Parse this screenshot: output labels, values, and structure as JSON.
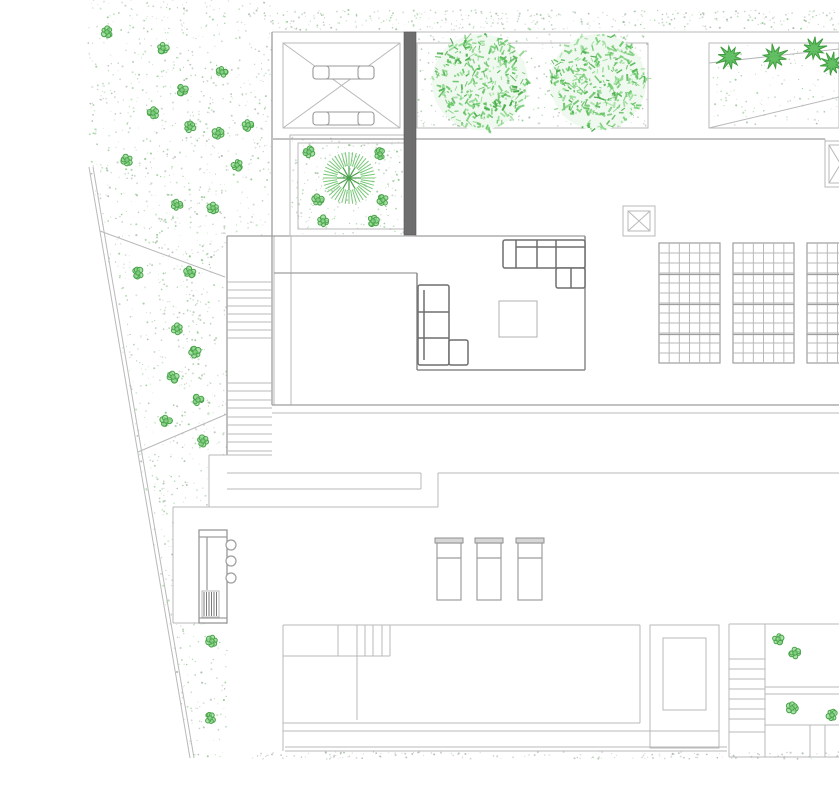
{
  "meta": {
    "drawing_type": "residential-site-plan",
    "canvas": {
      "width": 839,
      "height": 800
    }
  },
  "colors": {
    "background": "#ffffff",
    "line_light": "#b9b9b9",
    "line_mid": "#9e9e9e",
    "line_dark": "#8a8a8a",
    "furniture": "#6e6e6e",
    "dark_wall": "#6e6e6e",
    "vegetation_green": "#52b852",
    "bush_green": "#8fd68f",
    "palm_outer": "#76c776",
    "palm_inner": "#4aa04a"
  },
  "stipple": {
    "colors": [
      "#9fae9f",
      "#a8bba8",
      "#8fbf8f",
      "#b7c6b7",
      "#7fc87f"
    ],
    "ground_colors": [
      "#a9a9a9",
      "#b8beb8",
      "#9bb59b"
    ],
    "zones": [
      {
        "name": "top-band",
        "poly": [
          [
            272,
            10
          ],
          [
            839,
            10
          ],
          [
            839,
            30
          ],
          [
            272,
            30
          ]
        ],
        "dots": 380
      },
      {
        "name": "left-garden",
        "poly": [
          [
            88,
            0
          ],
          [
            272,
            0
          ],
          [
            272,
            236
          ],
          [
            227,
            236
          ],
          [
            227,
            455
          ],
          [
            209,
            455
          ],
          [
            209,
            507
          ],
          [
            173,
            507
          ],
          [
            173,
            623
          ],
          [
            227,
            623
          ],
          [
            227,
            757
          ],
          [
            190,
            757
          ],
          [
            89,
            167
          ]
        ],
        "dots": 1300
      },
      {
        "name": "courtyard",
        "poly": [
          [
            292,
            137
          ],
          [
            413,
            137
          ],
          [
            413,
            234
          ],
          [
            292,
            234
          ]
        ],
        "dots": 230
      },
      {
        "name": "tree-planter",
        "poly": [
          [
            417,
            34
          ],
          [
            648,
            34
          ],
          [
            648,
            127
          ],
          [
            417,
            127
          ]
        ],
        "dots": 420
      },
      {
        "name": "hedge-planter",
        "poly": [
          [
            711,
            45
          ],
          [
            837,
            45
          ],
          [
            837,
            126
          ],
          [
            711,
            126
          ]
        ],
        "dots": 110
      },
      {
        "name": "ground-dotted-line",
        "poly": [
          [
            250,
            752
          ],
          [
            839,
            752
          ],
          [
            839,
            759
          ],
          [
            250,
            759
          ]
        ],
        "dots": 160
      }
    ]
  },
  "lines": [
    [
      "roof-top-edge",
      272,
      32,
      839,
      32,
      "light"
    ],
    [
      "floor-top-edge",
      273,
      139,
      825,
      139,
      "mid"
    ],
    [
      "west-wall",
      272,
      32,
      272,
      405,
      "mid"
    ],
    [
      "stair-east-wall",
      274,
      236,
      274,
      405,
      "light"
    ],
    [
      "stair-west-wall",
      227,
      236,
      227,
      455,
      "mid"
    ],
    [
      "interior-wall",
      291,
      236,
      291,
      405,
      "light"
    ],
    [
      "terrace-top-edge",
      227,
      236,
      585,
      236,
      "mid"
    ],
    [
      "lounge-pit-top",
      274,
      273,
      417,
      273,
      "mid"
    ],
    [
      "lounge-pit-left",
      417,
      273,
      417,
      370,
      "dark"
    ],
    [
      "lounge-pit-bottom",
      417,
      370,
      585,
      370,
      "dark"
    ],
    [
      "lounge-pit-right",
      585,
      236,
      585,
      370,
      "dark"
    ],
    [
      "facade-line-1",
      272,
      405,
      839,
      405,
      "mid"
    ],
    [
      "facade-line-2",
      272,
      413,
      839,
      413,
      "light"
    ],
    [
      "stair-base-edge",
      209,
      455,
      272,
      455,
      "light"
    ],
    [
      "stair-base-west",
      209,
      455,
      209,
      507,
      "light"
    ],
    [
      "terrace-edge-west",
      227,
      473,
      421,
      473,
      "light"
    ],
    [
      "terrace-edge-east",
      438,
      473,
      839,
      473,
      "light"
    ],
    [
      "terrace-band-line",
      227,
      489,
      421,
      489,
      "light"
    ],
    [
      "step-corner-1",
      421,
      473,
      421,
      489,
      "light"
    ],
    [
      "step-corner-2",
      438,
      473,
      438,
      507,
      "light"
    ],
    [
      "deck-top-edge",
      173,
      507,
      438,
      507,
      "light"
    ],
    [
      "deck-west-edge",
      173,
      507,
      173,
      623,
      "light"
    ],
    [
      "deck-west-bottom",
      173,
      623,
      227,
      623,
      "light"
    ],
    [
      "fan-line-1",
      100,
      231,
      225,
      277,
      "light"
    ],
    [
      "fan-line-2",
      138,
      452,
      227,
      414,
      "light"
    ],
    [
      "boundary-line-1",
      89,
      167,
      190,
      758,
      "light"
    ],
    [
      "boundary-line-2",
      93,
      167,
      194,
      758,
      "light"
    ],
    [
      "pool-top",
      283,
      625,
      640,
      625,
      "light"
    ],
    [
      "pool-left",
      283,
      625,
      283,
      751,
      "light"
    ],
    [
      "pool-right",
      640,
      625,
      640,
      723,
      "light"
    ],
    [
      "pool-bottom",
      283,
      723,
      640,
      723,
      "light"
    ],
    [
      "pool-coping",
      283,
      731,
      719,
      731,
      "light"
    ],
    [
      "deck-bottom-1",
      285,
      747,
      727,
      747,
      "light"
    ],
    [
      "deck-bottom-2",
      285,
      751,
      727,
      751,
      "light"
    ],
    [
      "pool-ledge-right",
      338,
      625,
      338,
      656,
      "light"
    ],
    [
      "pool-ledge-bottom",
      283,
      656,
      390,
      656,
      "light"
    ],
    [
      "pool-step-divider",
      357,
      625,
      357,
      720,
      "light"
    ],
    [
      "pool-step-2",
      365,
      625,
      365,
      656,
      "light"
    ],
    [
      "pool-step-3",
      373,
      625,
      373,
      656,
      "light"
    ],
    [
      "pool-step-4",
      382,
      625,
      382,
      656,
      "light"
    ],
    [
      "pool-step-5",
      390,
      625,
      390,
      656,
      "light"
    ],
    [
      "patio-top-edge",
      729,
      624,
      839,
      624,
      "light"
    ],
    [
      "patio-stair-west",
      729,
      624,
      729,
      757,
      "light"
    ],
    [
      "patio-stair-east",
      765,
      624,
      765,
      757,
      "light"
    ],
    [
      "patio-divider-1",
      765,
      687,
      839,
      687,
      "light"
    ],
    [
      "patio-divider-2",
      765,
      694,
      839,
      694,
      "light"
    ],
    [
      "patio-lower-edge",
      765,
      725,
      839,
      725,
      "light"
    ],
    [
      "patio-post-1",
      810,
      725,
      810,
      757,
      "light"
    ],
    [
      "patio-post-2",
      825,
      725,
      825,
      757,
      "light"
    ],
    [
      "patio-bottom",
      729,
      757,
      839,
      757,
      "light"
    ],
    [
      "skylight-west-edge",
      825,
      139,
      825,
      187,
      "light"
    ],
    [
      "skylight-bottom-edge",
      825,
      187,
      839,
      187,
      "light"
    ],
    [
      "ramp-diagonal-1",
      709,
      63,
      839,
      49,
      "light"
    ],
    [
      "ramp-diagonal-2",
      709,
      128,
      839,
      97,
      "light"
    ],
    [
      "carport-diag-1",
      283,
      43,
      400,
      128,
      "light"
    ],
    [
      "carport-diag-2",
      283,
      128,
      400,
      43,
      "light"
    ]
  ],
  "rects": [
    [
      "carport-outline",
      283,
      43,
      117,
      85,
      "light",
      0
    ],
    [
      "courtyard-outer",
      290,
      135,
      125,
      101,
      "light",
      0
    ],
    [
      "courtyard-inner",
      298,
      143,
      109,
      86,
      "light",
      0
    ],
    [
      "tree-planter-box",
      417,
      43,
      231,
      85,
      "light",
      0
    ],
    [
      "hedge-planter-box",
      709,
      43,
      130,
      85,
      "light",
      0
    ],
    [
      "dark-wall",
      404,
      32,
      12,
      203,
      "wall",
      0
    ],
    [
      "spa-outer",
      650,
      625,
      69,
      123,
      "light",
      0
    ],
    [
      "spa-inner",
      663,
      638,
      43,
      72,
      "light",
      0
    ],
    [
      "bar-counter",
      199,
      530,
      28,
      93,
      "white",
      0
    ],
    [
      "counter-hatch-frame",
      202,
      591,
      17,
      26,
      "light",
      0
    ],
    [
      "coffee-table",
      499,
      301,
      38,
      36,
      "table",
      0
    ],
    [
      "sofa-right-main",
      503,
      240,
      82,
      28,
      "furn",
      2
    ],
    [
      "sofa-right-corner",
      556,
      268,
      29,
      20,
      "furn",
      2
    ],
    [
      "sofa-left-main",
      418,
      285,
      31,
      80,
      "furn",
      2
    ],
    [
      "sofa-left-ext",
      449,
      340,
      19,
      25,
      "furn",
      2
    ],
    [
      "car-bar-top",
      313,
      66,
      61,
      13,
      "car",
      4
    ],
    [
      "car-bar-bottom",
      313,
      112,
      61,
      13,
      "car",
      4
    ],
    [
      "car-cap-tl",
      313,
      66,
      16,
      13,
      "car",
      3
    ],
    [
      "car-cap-tr",
      358,
      66,
      16,
      13,
      "car",
      3
    ],
    [
      "car-cap-bl",
      313,
      112,
      16,
      13,
      "car",
      3
    ],
    [
      "car-cap-br",
      358,
      112,
      16,
      13,
      "car",
      3
    ]
  ],
  "detail_lines": [
    [
      "sofa-right-div-1",
      516,
      240,
      516,
      268,
      "furn"
    ],
    [
      "sofa-right-div-2",
      537,
      240,
      537,
      268,
      "furn"
    ],
    [
      "sofa-right-div-3",
      556,
      240,
      556,
      268,
      "furn"
    ],
    [
      "sofa-right-back",
      516,
      247,
      585,
      247,
      "furn"
    ],
    [
      "sofa-right-corner-div",
      571,
      268,
      571,
      288,
      "furn"
    ],
    [
      "sofa-left-back",
      424,
      290,
      424,
      360,
      "furn"
    ],
    [
      "sofa-left-div-1",
      418,
      312,
      449,
      312,
      "furn"
    ],
    [
      "sofa-left-div-2",
      418,
      338,
      449,
      338,
      "furn"
    ],
    [
      "counter-top-line",
      199,
      537,
      227,
      537,
      "mid"
    ],
    [
      "counter-mid-line",
      207,
      537,
      207,
      590,
      "mid"
    ],
    [
      "counter-bottom-line",
      199,
      618,
      227,
      618,
      "mid"
    ]
  ],
  "xboxes": [
    {
      "name": "vent-box",
      "o": [
        623,
        206,
        32,
        30
      ],
      "i": [
        628,
        211,
        22,
        20
      ]
    },
    {
      "name": "skylight-box",
      "o": [
        825,
        141,
        31,
        46
      ],
      "i": [
        829,
        145,
        23,
        38
      ]
    }
  ],
  "stairs": [
    {
      "name": "main-stair-upper-flight",
      "x1": 227,
      "x2": 272,
      "treads": [
        282,
        290,
        298,
        306,
        314,
        322,
        330,
        338
      ]
    },
    {
      "name": "main-stair-lower-flight",
      "x1": 227,
      "x2": 272,
      "treads": [
        383,
        391,
        400,
        408,
        417,
        425,
        434,
        442,
        451
      ]
    },
    {
      "name": "patio-stair",
      "x1": 729,
      "x2": 765,
      "treads": [
        659,
        669,
        679,
        689,
        699,
        709,
        719,
        732
      ]
    }
  ],
  "panels": {
    "pos": [
      [
        659,
        243
      ],
      [
        733,
        243
      ],
      [
        807,
        243
      ]
    ],
    "w": 61,
    "h": 120,
    "cols": 6,
    "rowstep": 10,
    "thick": [
      30,
      60,
      90
    ]
  },
  "loungers": {
    "xs": [
      437,
      477,
      518
    ],
    "y": 538,
    "w": 24,
    "h": 62,
    "head": 5,
    "div": 20
  },
  "stools": [
    [
      231,
      545
    ],
    [
      231,
      561
    ],
    [
      231,
      578
    ]
  ],
  "stool_r": 5,
  "hatch": {
    "x0": 204,
    "x1": 218,
    "step": 2.5,
    "y0": 592,
    "y1": 616
  },
  "trees": [
    [
      480,
      82,
      48
    ],
    [
      598,
      82,
      48
    ]
  ],
  "tree_colors": [
    "#54b854",
    "#67c667",
    "#7ad17a",
    "#8edc8e",
    "#49ab49"
  ],
  "palm": {
    "cx": 349,
    "cy": 178,
    "r1": 12,
    "r2": 26,
    "spokes": 44,
    "outer": "#76c776",
    "inner": "#4aa04a"
  },
  "bushes": [
    [
      107,
      32
    ],
    [
      163,
      48
    ],
    [
      222,
      72
    ],
    [
      182,
      90
    ],
    [
      153,
      113
    ],
    [
      190,
      127
    ],
    [
      218,
      133
    ],
    [
      248,
      125
    ],
    [
      127,
      160
    ],
    [
      237,
      165
    ],
    [
      177,
      205
    ],
    [
      213,
      208
    ],
    [
      138,
      273
    ],
    [
      190,
      272
    ],
    [
      177,
      329
    ],
    [
      195,
      352
    ],
    [
      173,
      377
    ],
    [
      198,
      400
    ],
    [
      166,
      421
    ],
    [
      203,
      441
    ],
    [
      212,
      641
    ],
    [
      210,
      718
    ],
    [
      309,
      152
    ],
    [
      380,
      154
    ],
    [
      318,
      200
    ],
    [
      383,
      200
    ],
    [
      323,
      221
    ],
    [
      373,
      221
    ],
    [
      778,
      639
    ],
    [
      795,
      653
    ],
    [
      792,
      708
    ],
    [
      832,
      715
    ]
  ],
  "shrubs": [
    [
      730,
      57,
      14,
      0.2
    ],
    [
      774,
      57,
      14,
      0.8
    ],
    [
      814,
      49,
      13,
      0.4
    ],
    [
      832,
      64,
      12,
      1.1
    ]
  ]
}
